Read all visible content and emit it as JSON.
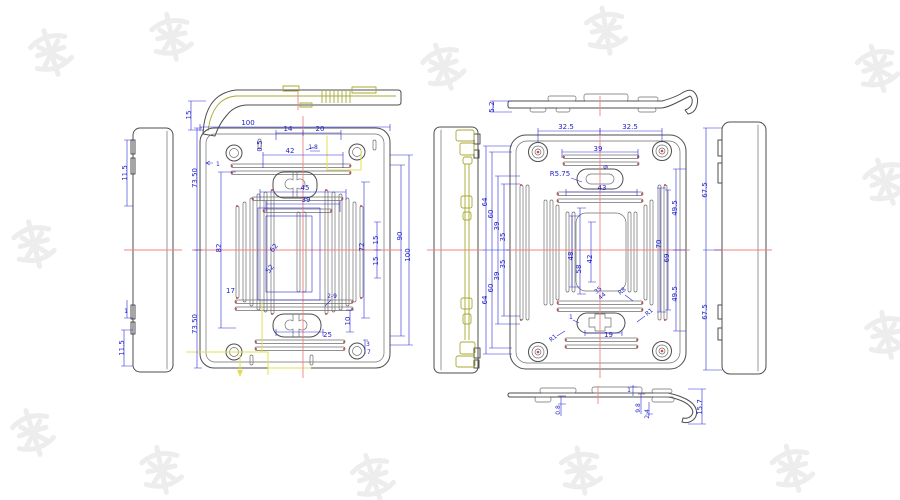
{
  "document": {
    "type": "cad-technical-drawing",
    "description": "Six-view mechanical drawing of a molded cover plate with dimension annotations"
  },
  "colors": {
    "dimension_blue": "#2a2ad4",
    "outline_gray": "#4d4d4d",
    "centerline_red": "#f08484",
    "construction_yellow": "#e0e050",
    "profile_olive": "#a8a832",
    "watermark_gray": "#ededed"
  },
  "v": {
    "tp15": "15",
    "ls": {
      "a": "11.5",
      "b": "1",
      "c": "11.5"
    },
    "lm": {
      "w100": "100",
      "d14": "14",
      "d20": "20",
      "d05": "0.5",
      "d18": "1.8",
      "d1": "1",
      "d42": "42",
      "d45": "45",
      "d39": "39",
      "h73a": "73.50",
      "h73b": "73.50",
      "h82": "82",
      "d62": "62",
      "d52": "52",
      "d17": "17",
      "h72": "72",
      "h15a": "15",
      "h15b": "15",
      "h90": "90",
      "h100": "100",
      "b29": "2-9",
      "b10": "10",
      "b25": "25",
      "b3": "3",
      "b7": "7"
    },
    "rm": {
      "t32a": "32.5",
      "t32b": "32.5",
      "t39": "39",
      "r575": "R5.75",
      "t9": "9",
      "t43": "43",
      "l64a": "64",
      "l60a": "60",
      "l39a": "39",
      "l35a": "35",
      "l35b": "35",
      "l39b": "39",
      "l60b": "60",
      "l64b": "64",
      "c48": "48",
      "c58": "58",
      "c42": "42",
      "c35": "35",
      "c44": "44",
      "r8": "R8",
      "b1": "1",
      "b19": "19",
      "r1a": "R1",
      "r1b": "R1",
      "r70": "70",
      "r69": "69",
      "r49a": "49.5",
      "r49b": "49.5"
    },
    "rs": {
      "a": "67.5",
      "b": "67.5"
    },
    "rtp": {
      "h": "5.2"
    },
    "rbp": {
      "a": "0.8",
      "b": "1",
      "c": "9.8",
      "d": "2.4",
      "e": "15.7"
    }
  }
}
